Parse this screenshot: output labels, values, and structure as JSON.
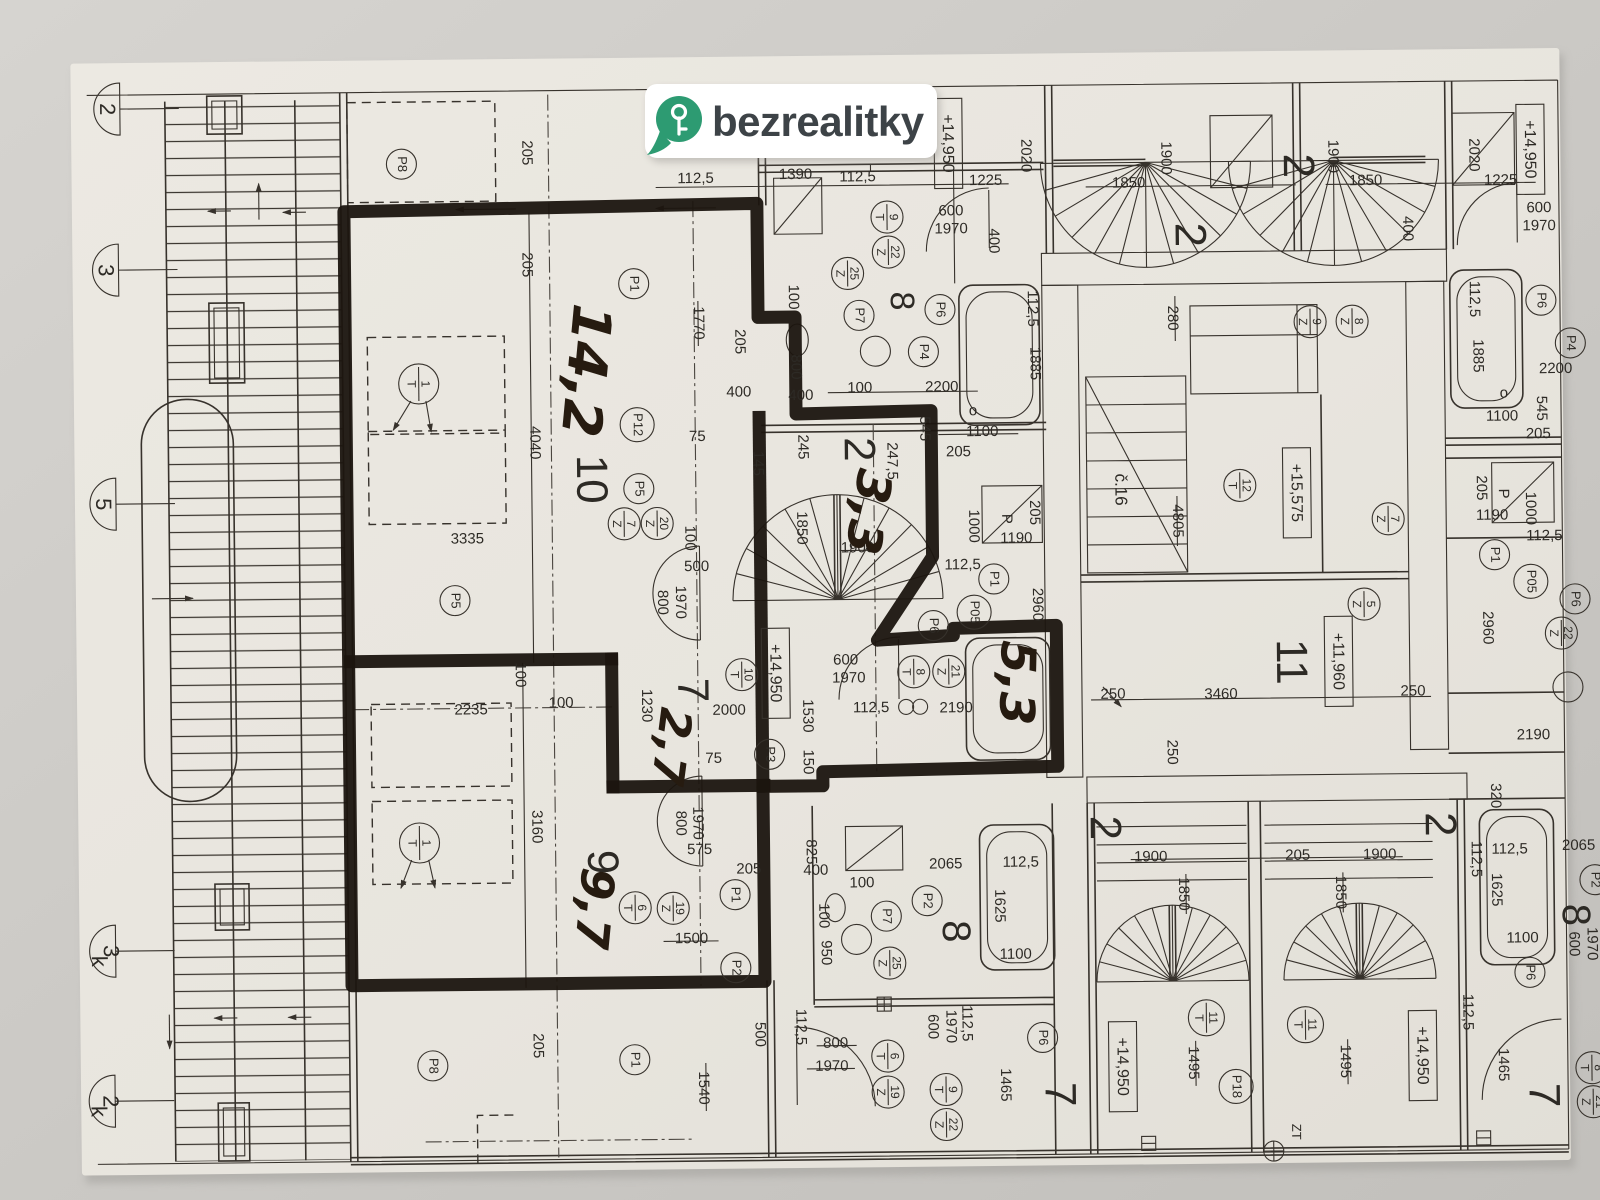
{
  "logo": {
    "text": "bezrealitky",
    "pin_color": "#2D9B72",
    "text_color": "#3d4347",
    "key_color": "#ffffff"
  },
  "photo": {
    "table_color": "#cdcbc7",
    "paper_color": "#eae7e0",
    "line_color": "#37322c",
    "marker_color": "#1b150f",
    "hand_color": "#261b10"
  },
  "handwritten_areas": [
    {
      "t": "14,2",
      "x": 585,
      "y": 368,
      "r": 96,
      "s": 54
    },
    {
      "t": "3,3",
      "x": 866,
      "y": 512,
      "r": 100,
      "s": 48
    },
    {
      "t": "5,3",
      "x": 1013,
      "y": 685,
      "r": 92,
      "s": 48
    },
    {
      "t": "2,7",
      "x": 667,
      "y": 745,
      "r": 98,
      "s": 44
    },
    {
      "t": "9,7",
      "x": 588,
      "y": 906,
      "r": 96,
      "s": 46
    }
  ],
  "room_numbers": [
    {
      "t": "10",
      "x": 590,
      "y": 477
    },
    {
      "t": "2",
      "x": 858,
      "y": 450
    },
    {
      "t": "8",
      "x": 903,
      "y": 302,
      "s": 34
    },
    {
      "t": "7",
      "x": 689,
      "y": 689
    },
    {
      "t": "9",
      "x": 597,
      "y": 860
    },
    {
      "t": "8",
      "x": 950,
      "y": 933,
      "s": 40
    },
    {
      "t": "7",
      "x": 1052,
      "y": 1097
    },
    {
      "t": "11",
      "x": 1288,
      "y": 667
    },
    {
      "t": "2",
      "x": 1191,
      "y": 239
    },
    {
      "t": "2",
      "x": 1300,
      "y": 171
    },
    {
      "t": "2",
      "x": 1100,
      "y": 831
    },
    {
      "t": "2",
      "x": 1435,
      "y": 831
    },
    {
      "t": "8",
      "x": 1570,
      "y": 923,
      "s": 40
    },
    {
      "t": "7",
      "x": 1536,
      "y": 1103
    }
  ],
  "elevation_marks": [
    {
      "t": "+14,950",
      "x": 953,
      "y": 145
    },
    {
      "t": "+14,950",
      "x": 1535,
      "y": 157
    },
    {
      "t": "+14,950",
      "x": 775,
      "y": 673
    },
    {
      "t": "+15,575",
      "x": 1298,
      "y": 498
    },
    {
      "t": "+11,960",
      "x": 1338,
      "y": 667
    },
    {
      "t": "+14,950",
      "x": 1118,
      "y": 1070
    },
    {
      "t": "+14,950",
      "x": 1418,
      "y": 1062
    }
  ],
  "axis_markers": [
    {
      "t": "2",
      "x": 112,
      "y": 102
    },
    {
      "t": "3",
      "x": 109,
      "y": 263
    },
    {
      "t": "5",
      "x": 104,
      "y": 497
    },
    {
      "t": "3",
      "sub": "k",
      "x": 99,
      "y": 944
    },
    {
      "t": "2",
      "sub": "k",
      "x": 97,
      "y": 1094
    }
  ],
  "position_circles": [
    {
      "t": "P8",
      "x": 406,
      "y": 160
    },
    {
      "t": "P1",
      "x": 637,
      "y": 282
    },
    {
      "t": "P12",
      "x": 639,
      "y": 423,
      "d": 34
    },
    {
      "t": "P5",
      "x": 640,
      "y": 487
    },
    {
      "t": "P5",
      "x": 455,
      "y": 597
    },
    {
      "t": "P7",
      "x": 862,
      "y": 316
    },
    {
      "t": "P6",
      "x": 943,
      "y": 311
    },
    {
      "t": "P4",
      "x": 926,
      "y": 353
    },
    {
      "t": "P3",
      "x": 768,
      "y": 754
    },
    {
      "t": "P1",
      "x": 732,
      "y": 894
    },
    {
      "t": "P2",
      "x": 732,
      "y": 967
    },
    {
      "t": "P8",
      "x": 428,
      "y": 1062
    },
    {
      "t": "P1",
      "x": 630,
      "y": 1058
    },
    {
      "t": "P6",
      "x": 933,
      "y": 627
    },
    {
      "t": "P1",
      "x": 994,
      "y": 581
    },
    {
      "t": "P05",
      "x": 974,
      "y": 614,
      "d": 34
    },
    {
      "t": "P7",
      "x": 883,
      "y": 917
    },
    {
      "t": "P2",
      "x": 924,
      "y": 902
    },
    {
      "t": "P6",
      "x": 1038,
      "y": 1040
    },
    {
      "t": "P18",
      "x": 1231,
      "y": 1091,
      "d": 34
    },
    {
      "t": "P6",
      "x": 1544,
      "y": 308
    },
    {
      "t": "P4",
      "x": 1573,
      "y": 351
    },
    {
      "t": "P1",
      "x": 1495,
      "y": 562
    },
    {
      "t": "P05",
      "x": 1531,
      "y": 589,
      "d": 34
    },
    {
      "t": "P6",
      "x": 1575,
      "y": 607
    },
    {
      "t": "P6",
      "x": 1526,
      "y": 980
    },
    {
      "t": "P2",
      "x": 1592,
      "y": 888
    }
  ],
  "symbol_circles": [
    {
      "a": "9",
      "b": "T",
      "x": 891,
      "y": 218
    },
    {
      "a": "22",
      "b": "Z",
      "x": 892,
      "y": 253
    },
    {
      "a": "25",
      "b": "Z",
      "x": 851,
      "y": 274
    },
    {
      "a": "1",
      "b": "T",
      "x": 421,
      "y": 380,
      "d": 40
    },
    {
      "a": "1",
      "b": "T",
      "x": 417,
      "y": 839,
      "d": 40
    },
    {
      "a": "7",
      "b": "Z",
      "x": 625,
      "y": 522
    },
    {
      "a": "20",
      "b": "Z",
      "x": 658,
      "y": 522
    },
    {
      "a": "10",
      "b": "T",
      "x": 741,
      "y": 674
    },
    {
      "a": "8",
      "b": "T",
      "x": 913,
      "y": 673
    },
    {
      "a": "21",
      "b": "Z",
      "x": 948,
      "y": 673
    },
    {
      "a": "6",
      "b": "T",
      "x": 632,
      "y": 906
    },
    {
      "a": "19",
      "b": "Z",
      "x": 670,
      "y": 907
    },
    {
      "a": "12",
      "b": "T",
      "x": 1241,
      "y": 490
    },
    {
      "a": "9",
      "b": "Z",
      "x": 1313,
      "y": 327
    },
    {
      "a": "8",
      "b": "Z",
      "x": 1355,
      "y": 327
    },
    {
      "a": "7",
      "b": "Z",
      "x": 1389,
      "y": 525
    },
    {
      "a": "5",
      "b": "Z",
      "x": 1364,
      "y": 610
    },
    {
      "a": "25",
      "b": "Z",
      "x": 886,
      "y": 964
    },
    {
      "a": "6",
      "b": "T",
      "x": 883,
      "y": 1057
    },
    {
      "a": "19",
      "b": "Z",
      "x": 883,
      "y": 1093
    },
    {
      "a": "9",
      "b": "T",
      "x": 941,
      "y": 1091
    },
    {
      "a": "22",
      "b": "Z",
      "x": 941,
      "y": 1126
    },
    {
      "a": "11",
      "b": "T",
      "x": 1202,
      "y": 1022,
      "d": 36
    },
    {
      "a": "11",
      "b": "T",
      "x": 1301,
      "y": 1030,
      "d": 36
    },
    {
      "a": "22",
      "b": "Z",
      "x": 1561,
      "y": 641
    },
    {
      "a": "8",
      "b": "T",
      "x": 1587,
      "y": 1076
    },
    {
      "a": "21",
      "b": "Z",
      "x": 1588,
      "y": 1110
    }
  ],
  "dimension_labels": [
    {
      "t": "112,5",
      "x": 700,
      "y": 178,
      "r": 0
    },
    {
      "t": "1390",
      "x": 800,
      "y": 175,
      "r": 0
    },
    {
      "t": "112,5",
      "x": 862,
      "y": 178,
      "r": 0
    },
    {
      "t": "1225",
      "x": 990,
      "y": 183,
      "r": 0
    },
    {
      "t": "2020",
      "x": 1030,
      "y": 158,
      "r": 90
    },
    {
      "t": "1850",
      "x": 1133,
      "y": 187,
      "r": 0
    },
    {
      "t": "1900",
      "x": 1170,
      "y": 162,
      "r": 90
    },
    {
      "t": "1900",
      "x": 1337,
      "y": 162,
      "r": 90
    },
    {
      "t": "1850",
      "x": 1370,
      "y": 187,
      "r": 0
    },
    {
      "t": "2020",
      "x": 1478,
      "y": 162,
      "r": 90
    },
    {
      "t": "1225",
      "x": 1505,
      "y": 188,
      "r": 0
    },
    {
      "t": "600",
      "x": 955,
      "y": 213,
      "r": 0
    },
    {
      "t": "1970",
      "x": 955,
      "y": 231,
      "r": 0
    },
    {
      "t": "600",
      "x": 1543,
      "y": 216,
      "r": 0
    },
    {
      "t": "1970",
      "x": 1543,
      "y": 234,
      "r": 0
    },
    {
      "t": "400",
      "x": 997,
      "y": 243,
      "r": 90
    },
    {
      "t": "400",
      "x": 1411,
      "y": 235,
      "r": 90
    },
    {
      "t": "100",
      "x": 796,
      "y": 297,
      "r": 90
    },
    {
      "t": "800",
      "x": 798,
      "y": 367,
      "r": 90
    },
    {
      "t": "400",
      "x": 803,
      "y": 396,
      "r": 0
    },
    {
      "t": "100",
      "x": 862,
      "y": 389,
      "r": 0
    },
    {
      "t": "2200",
      "x": 944,
      "y": 389,
      "r": 0
    },
    {
      "t": "112,5",
      "x": 1035,
      "y": 311,
      "r": 90
    },
    {
      "t": "1885",
      "x": 1037,
      "y": 366,
      "r": 90
    },
    {
      "t": "545",
      "x": 926,
      "y": 430,
      "r": 90
    },
    {
      "t": "1100",
      "x": 984,
      "y": 434,
      "r": 0
    },
    {
      "t": "205",
      "x": 960,
      "y": 454,
      "r": 0
    },
    {
      "t": "112,5",
      "x": 1477,
      "y": 306,
      "r": 90
    },
    {
      "t": "1885",
      "x": 1480,
      "y": 363,
      "r": 90
    },
    {
      "t": "545",
      "x": 1543,
      "y": 416,
      "r": 90
    },
    {
      "t": "1100",
      "x": 1504,
      "y": 424,
      "r": 0
    },
    {
      "t": "205",
      "x": 1540,
      "y": 442,
      "r": 0
    },
    {
      "t": "2200",
      "x": 1558,
      "y": 377,
      "r": 0
    },
    {
      "t": "205",
      "x": 531,
      "y": 150,
      "r": 90
    },
    {
      "t": "205",
      "x": 530,
      "y": 262,
      "r": 90
    },
    {
      "t": "4040",
      "x": 536,
      "y": 440,
      "r": 90
    },
    {
      "t": "3335",
      "x": 468,
      "y": 536,
      "r": 0
    },
    {
      "t": "1770",
      "x": 701,
      "y": 322,
      "r": 90
    },
    {
      "t": "205",
      "x": 742,
      "y": 341,
      "r": 90
    },
    {
      "t": "400",
      "x": 741,
      "y": 392,
      "r": 0
    },
    {
      "t": "75",
      "x": 699,
      "y": 436,
      "r": 0
    },
    {
      "t": "145",
      "x": 759,
      "y": 463,
      "r": 90
    },
    {
      "t": "245",
      "x": 804,
      "y": 447,
      "r": 90
    },
    {
      "t": "247,5",
      "x": 893,
      "y": 462,
      "r": 90
    },
    {
      "t": "1850",
      "x": 802,
      "y": 528,
      "r": 90
    },
    {
      "t": "1900",
      "x": 858,
      "y": 549,
      "r": 0
    },
    {
      "t": "100",
      "x": 690,
      "y": 537,
      "r": 90
    },
    {
      "t": "500",
      "x": 697,
      "y": 566,
      "r": 0
    },
    {
      "t": "800",
      "x": 662,
      "y": 601,
      "r": 90
    },
    {
      "t": "1970",
      "x": 680,
      "y": 601,
      "r": 90
    },
    {
      "t": "100",
      "x": 519,
      "y": 672,
      "r": 90
    },
    {
      "t": "2235",
      "x": 470,
      "y": 707,
      "r": 0
    },
    {
      "t": "100",
      "x": 560,
      "y": 701,
      "r": 0
    },
    {
      "t": "1230",
      "x": 645,
      "y": 704,
      "r": 90
    },
    {
      "t": "2000",
      "x": 728,
      "y": 710,
      "r": 0
    },
    {
      "t": "3160",
      "x": 534,
      "y": 824,
      "r": 90
    },
    {
      "t": "1530",
      "x": 806,
      "y": 716,
      "r": 90
    },
    {
      "t": "75",
      "x": 712,
      "y": 758,
      "r": 0
    },
    {
      "t": "150",
      "x": 806,
      "y": 762,
      "r": 90
    },
    {
      "t": "800",
      "x": 678,
      "y": 822,
      "r": 90
    },
    {
      "t": "1970",
      "x": 695,
      "y": 822,
      "r": 90
    },
    {
      "t": "575",
      "x": 697,
      "y": 849,
      "r": 0
    },
    {
      "t": "205",
      "x": 746,
      "y": 869,
      "r": 0
    },
    {
      "t": "1500",
      "x": 688,
      "y": 938,
      "r": 0
    },
    {
      "t": "205",
      "x": 533,
      "y": 1043,
      "r": 90
    },
    {
      "t": "1540",
      "x": 698,
      "y": 1087,
      "r": 90
    },
    {
      "t": "500",
      "x": 755,
      "y": 1034,
      "r": 90
    },
    {
      "t": "112,5",
      "x": 796,
      "y": 1027,
      "r": 90
    },
    {
      "t": "205",
      "x": 1035,
      "y": 515,
      "r": 90
    },
    {
      "t": "P",
      "x": 1007,
      "y": 521,
      "r": 90
    },
    {
      "t": "1190",
      "x": 1017,
      "y": 541,
      "r": 0
    },
    {
      "t": "1000",
      "x": 974,
      "y": 528,
      "r": 90
    },
    {
      "t": "112,5",
      "x": 963,
      "y": 567,
      "r": 0
    },
    {
      "t": "2960",
      "x": 1037,
      "y": 607,
      "r": 90
    },
    {
      "t": "600",
      "x": 845,
      "y": 661,
      "r": 0
    },
    {
      "t": "1970",
      "x": 848,
      "y": 679,
      "r": 0
    },
    {
      "t": "112,5",
      "x": 870,
      "y": 709,
      "r": 0
    },
    {
      "t": "2190",
      "x": 955,
      "y": 710,
      "r": 0
    },
    {
      "t": "280",
      "x": 1175,
      "y": 322,
      "r": 90
    },
    {
      "t": "4805",
      "x": 1178,
      "y": 525,
      "r": 90
    },
    {
      "t": "250",
      "x": 1112,
      "y": 698,
      "r": 0
    },
    {
      "t": "3460",
      "x": 1220,
      "y": 699,
      "r": 0
    },
    {
      "t": "250",
      "x": 1412,
      "y": 698,
      "r": 0
    },
    {
      "t": "250",
      "x": 1170,
      "y": 756,
      "r": 90
    },
    {
      "t": "205",
      "x": 1482,
      "y": 495,
      "r": 90
    },
    {
      "t": "P",
      "x": 1504,
      "y": 501,
      "r": 90
    },
    {
      "t": "1190",
      "x": 1493,
      "y": 523,
      "r": 0
    },
    {
      "t": "1000",
      "x": 1531,
      "y": 516,
      "r": 90
    },
    {
      "t": "112,5",
      "x": 1545,
      "y": 544,
      "r": 0
    },
    {
      "t": "2960",
      "x": 1487,
      "y": 635,
      "r": 90
    },
    {
      "t": "2190",
      "x": 1532,
      "y": 743,
      "r": 0
    },
    {
      "t": "320",
      "x": 1493,
      "y": 803,
      "r": 90
    },
    {
      "t": "825",
      "x": 808,
      "y": 852,
      "r": 90
    },
    {
      "t": "400",
      "x": 813,
      "y": 871,
      "r": 0
    },
    {
      "t": "100",
      "x": 859,
      "y": 884,
      "r": 0
    },
    {
      "t": "100",
      "x": 820,
      "y": 916,
      "r": 90
    },
    {
      "t": "950",
      "x": 822,
      "y": 953,
      "r": 90
    },
    {
      "t": "2065",
      "x": 943,
      "y": 866,
      "r": 0
    },
    {
      "t": "112,5",
      "x": 1018,
      "y": 865,
      "r": 0
    },
    {
      "t": "1625",
      "x": 996,
      "y": 908,
      "r": 90
    },
    {
      "t": "1100",
      "x": 1012,
      "y": 957,
      "r": 0
    },
    {
      "t": "800",
      "x": 831,
      "y": 1044,
      "r": 0
    },
    {
      "t": "1970",
      "x": 827,
      "y": 1067,
      "r": 0
    },
    {
      "t": "600",
      "x": 928,
      "y": 1028,
      "r": 90
    },
    {
      "t": "1970",
      "x": 946,
      "y": 1028,
      "r": 90
    },
    {
      "t": "112,5",
      "x": 962,
      "y": 1025,
      "r": 90
    },
    {
      "t": "1465",
      "x": 1000,
      "y": 1087,
      "r": 90
    },
    {
      "t": "1900",
      "x": 1148,
      "y": 861,
      "r": 0
    },
    {
      "t": "205",
      "x": 1295,
      "y": 861,
      "r": 0
    },
    {
      "t": "1900",
      "x": 1377,
      "y": 861,
      "r": 0
    },
    {
      "t": "1850",
      "x": 1180,
      "y": 898,
      "r": 90
    },
    {
      "t": "1850",
      "x": 1337,
      "y": 898,
      "r": 90
    },
    {
      "t": "1495",
      "x": 1188,
      "y": 1067,
      "r": 90
    },
    {
      "t": "1495",
      "x": 1340,
      "y": 1067,
      "r": 90
    },
    {
      "t": "112,5",
      "x": 1473,
      "y": 866,
      "r": 90
    },
    {
      "t": "112,5",
      "x": 1463,
      "y": 1019,
      "r": 90
    },
    {
      "t": "2065",
      "x": 1576,
      "y": 854,
      "r": 0
    },
    {
      "t": "112,5",
      "x": 1507,
      "y": 857,
      "r": 0
    },
    {
      "t": "1625",
      "x": 1493,
      "y": 897,
      "r": 90
    },
    {
      "t": "1100",
      "x": 1519,
      "y": 946,
      "r": 0
    },
    {
      "t": "600",
      "x": 1570,
      "y": 952,
      "r": 90
    },
    {
      "t": "1970",
      "x": 1588,
      "y": 952,
      "r": 90
    },
    {
      "t": "1465",
      "x": 1498,
      "y": 1072,
      "r": 90
    }
  ],
  "misc_labels": [
    {
      "t": "č.16",
      "x": 1121,
      "y": 493,
      "r": 90,
      "s": 17
    },
    {
      "t": "ZT",
      "x": 1290,
      "y": 1137,
      "r": 90,
      "s": 13
    },
    {
      "t": "o",
      "x": 975,
      "y": 413,
      "r": 0,
      "s": 15
    },
    {
      "t": "o",
      "x": 1506,
      "y": 401,
      "r": 0,
      "s": 15
    }
  ]
}
